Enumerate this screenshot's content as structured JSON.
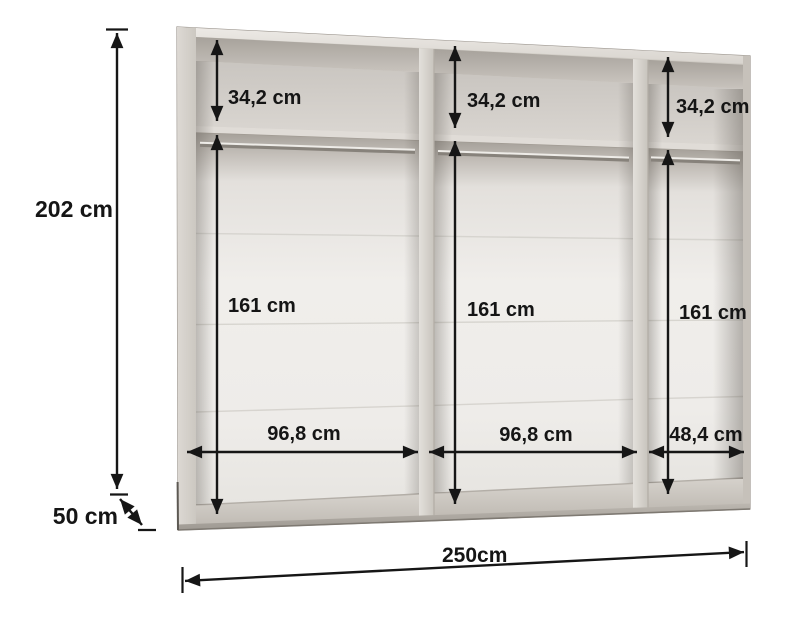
{
  "palette": {
    "line_color": "#161616",
    "text_color": "#151515",
    "carcass_color": "#d6d2cc",
    "carcass_shadow": "#a9a49d",
    "back_panel_color": "#efedea",
    "background": "#ffffff"
  },
  "diagram": {
    "overall": {
      "height_label": "202 cm",
      "depth_label": "50 cm",
      "total_width_label": "250cm"
    },
    "sections": [
      {
        "top_shelf_height_label": "34,2 cm",
        "hanging_height_label": "161 cm",
        "width_label": "96,8 cm"
      },
      {
        "top_shelf_height_label": "34,2 cm",
        "hanging_height_label": "161 cm",
        "width_label": "96,8 cm"
      },
      {
        "top_shelf_height_label": "34,2 cm",
        "hanging_height_label": "161 cm",
        "width_label": "48,4 cm"
      }
    ]
  }
}
